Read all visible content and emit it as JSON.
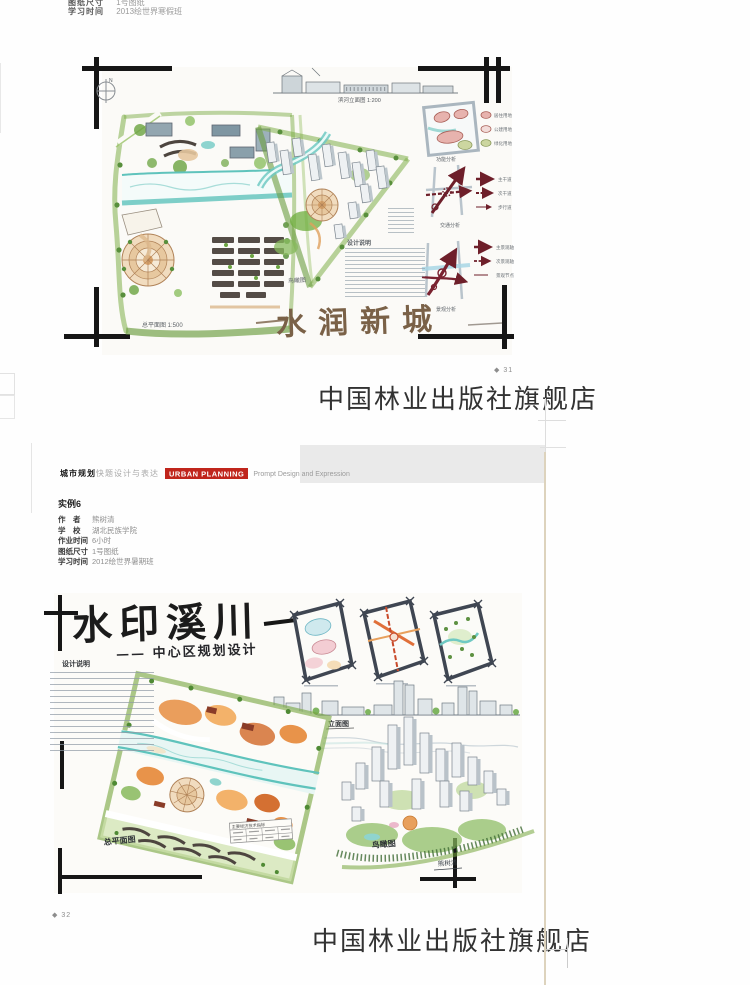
{
  "scan": {
    "watermark": "中国林业出版社旗舰店"
  },
  "top_labels": {
    "rows": [
      {
        "label": "图纸尺寸",
        "value": "1号图纸"
      },
      {
        "label": "学习时间",
        "value": "2013绘世界寒假班"
      }
    ]
  },
  "page1": {
    "page_number": "◆ 31",
    "artwork": {
      "title": "水润新城",
      "compass": "N",
      "elevation_label": "滨河立面图 1:200",
      "plan_label": "总平面图 1:500",
      "birdseye_label": "鸟瞰图",
      "notes_title": "设计说明",
      "analysis_labels": [
        "功能分析",
        "交通分析",
        "景观分析"
      ],
      "zoning_legend": [
        "居住用地",
        "公建用地",
        "绿化用地"
      ],
      "traffic_legend": [
        "主干道",
        "次干道",
        "步行道"
      ],
      "landscape_legend": [
        "主景观轴",
        "次景观轴",
        "景观节点"
      ]
    }
  },
  "page2": {
    "page_number": "◆ 32",
    "header": {
      "series_bold": "城市规划",
      "series_light": "快题设计与表达",
      "badge": "URBAN PLANNING",
      "subtitle": "Prompt Design and Expression"
    },
    "example": {
      "title": "实例6",
      "rows": [
        {
          "label": "作　者",
          "value": "熊树清"
        },
        {
          "label": "学　校",
          "value": "湖北民族学院"
        },
        {
          "label": "作业时间",
          "value": "6小时"
        },
        {
          "label": "图纸尺寸",
          "value": "1号图纸"
        },
        {
          "label": "学习时间",
          "value": "2012绘世界暑期班"
        }
      ]
    },
    "artwork": {
      "title": "水印溪川",
      "subtitle": "—— 中心区规划设计",
      "notes_title": "设计说明",
      "elevation_label": "立面图",
      "plan_label": "总平面图",
      "birdseye_label": "鸟瞰图",
      "table_title": "主要经济技术指标",
      "signature": "熊树清"
    }
  },
  "colors": {
    "badge_red": "#c0251c",
    "water_teal": "#5fc3bc",
    "landscape_green": "#74a53c",
    "analysis_dark_red": "#6e1f2a",
    "plaza_tan": "#f1dcbf",
    "calligraphy_brown": "#7a6147"
  }
}
